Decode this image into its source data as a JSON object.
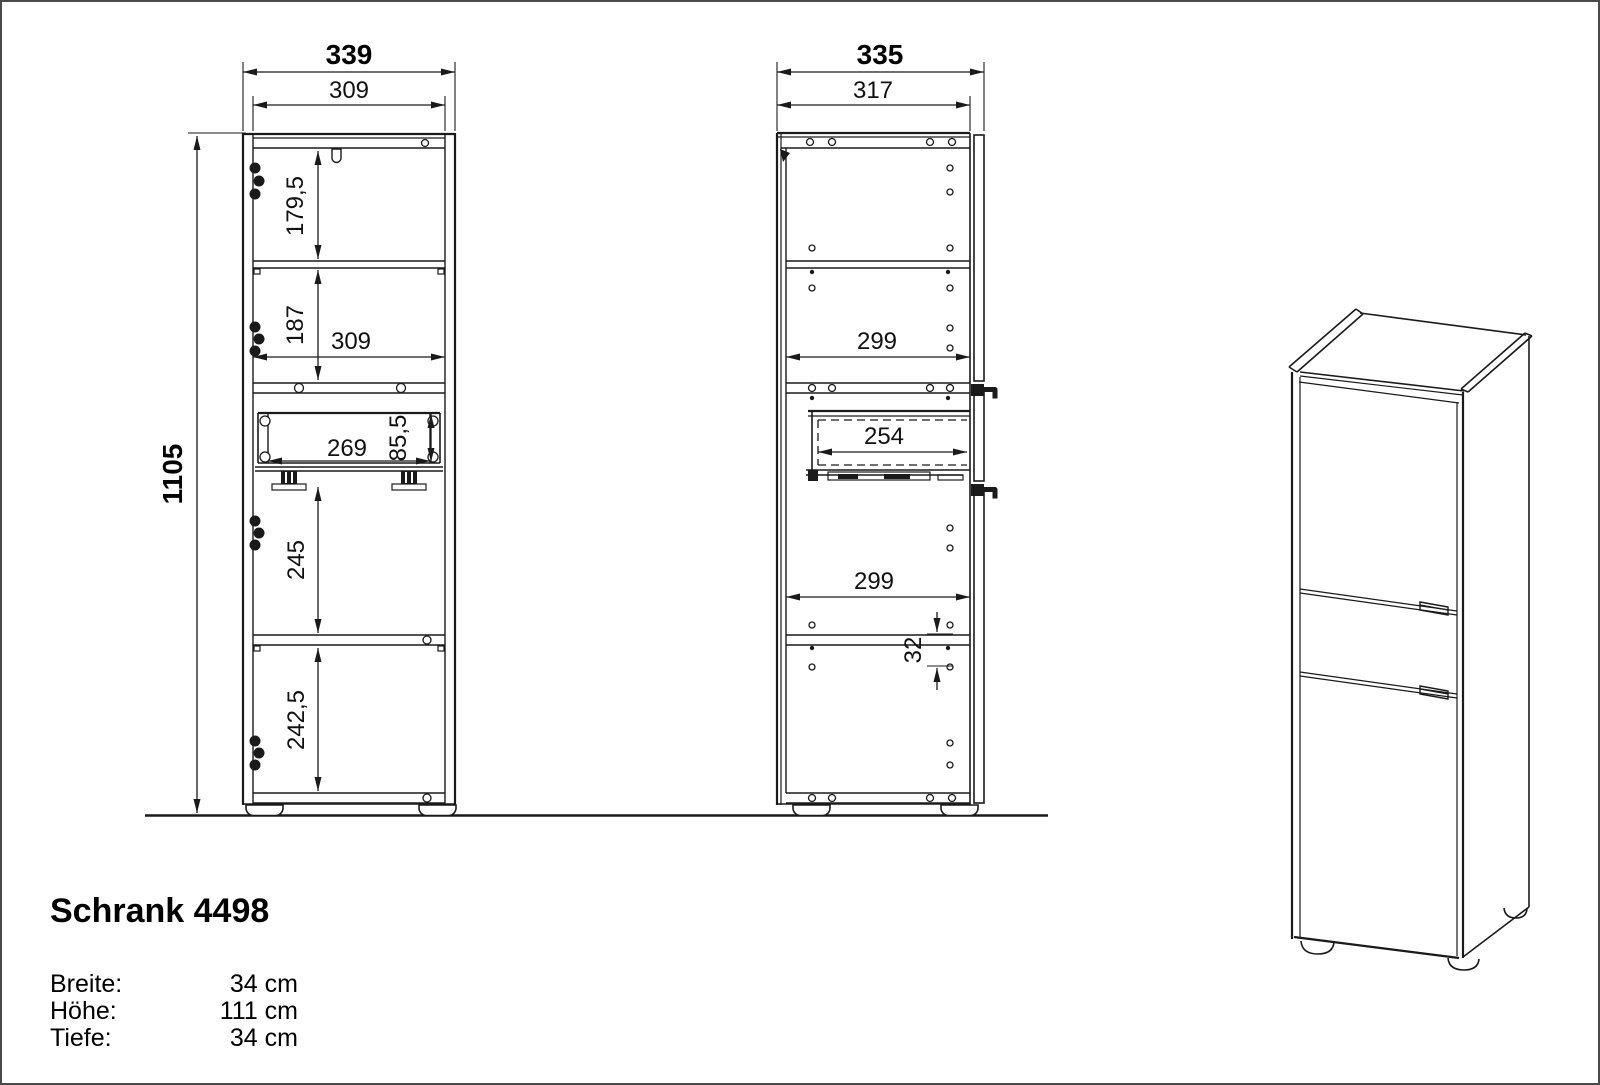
{
  "front_view": {
    "dimensions": {
      "total_width": "339",
      "top_inner_width": "309",
      "total_height": "1105",
      "top_compartment_height": "179,5",
      "second_compartment_height": "187",
      "inner_width": "309",
      "drawer_inner_width": "269",
      "drawer_inner_height": "85,5",
      "third_compartment_height": "245",
      "bottom_compartment_height": "242,5"
    }
  },
  "side_view": {
    "dimensions": {
      "total_depth": "335",
      "top_inner_depth": "317",
      "upper_shelf_depth": "299",
      "drawer_depth": "254",
      "lower_shelf_depth": "299",
      "hole_spacing": "32"
    }
  },
  "product": {
    "title": "Schrank 4498",
    "specs": [
      {
        "label": "Breite:",
        "value": "34 cm"
      },
      {
        "label": "Höhe:",
        "value": "111 cm"
      },
      {
        "label": "Tiefe:",
        "value": "34 cm"
      }
    ]
  },
  "colors": {
    "line": "#1a1a1a",
    "background": "#ffffff",
    "border": "#4a4a4a"
  }
}
